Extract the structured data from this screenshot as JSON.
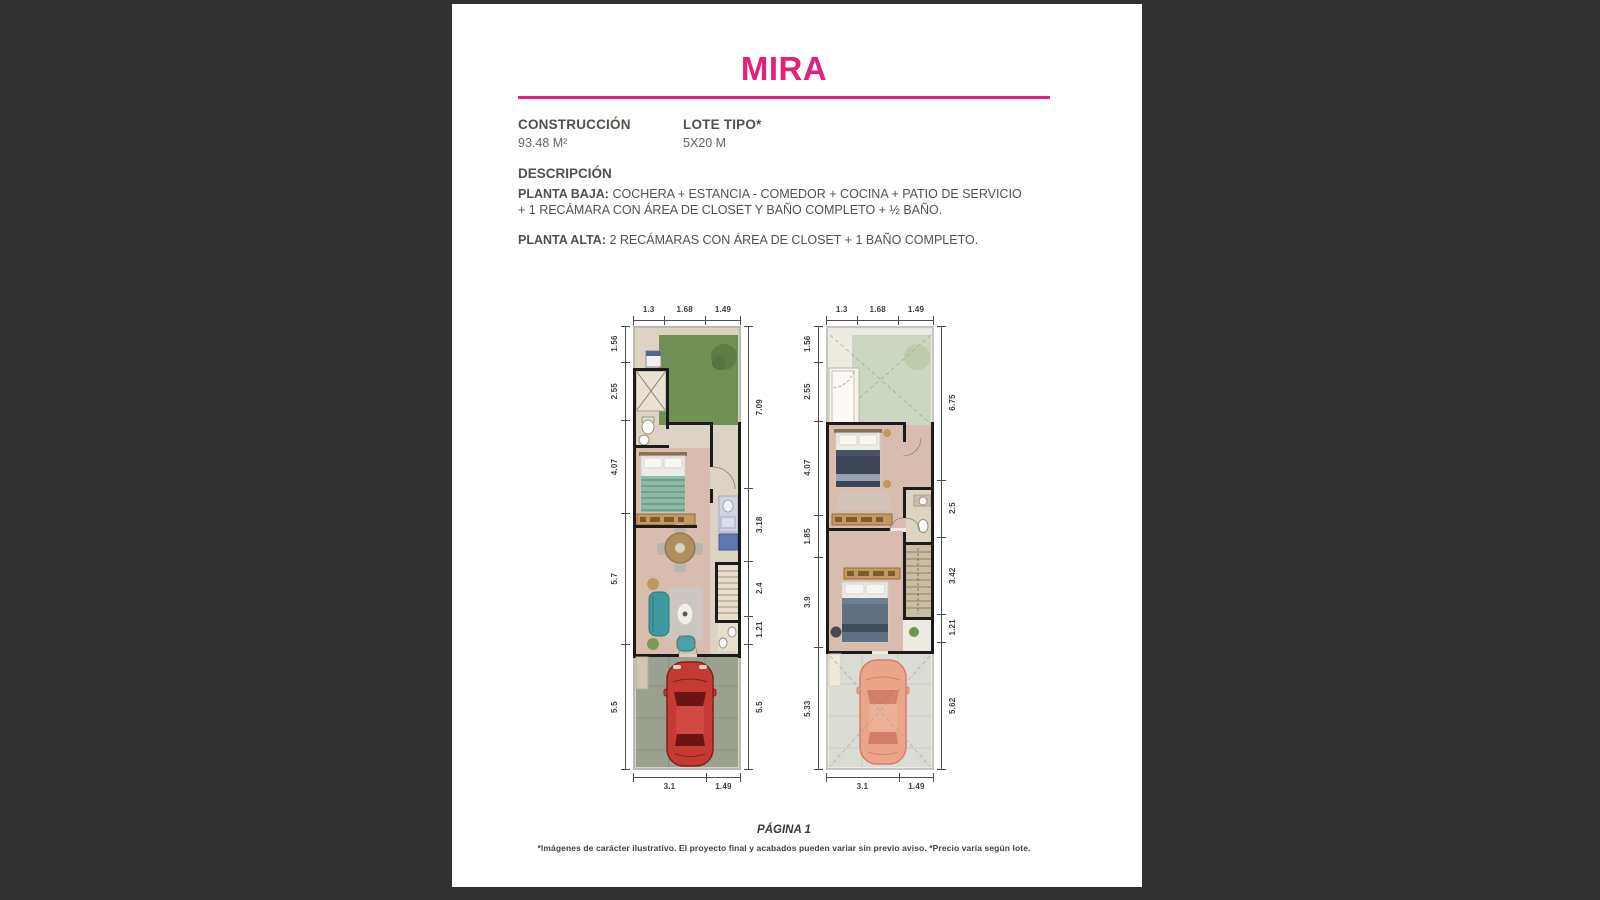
{
  "window": {
    "background": "#313131",
    "page_background": "#ffffff"
  },
  "header": {
    "title": "MIRA",
    "accent_color": "#E5207C"
  },
  "specs": [
    {
      "label": "CONSTRUCCIÓN",
      "value": "93.48 M²"
    },
    {
      "label": "LOTE TIPO*",
      "value": "5X20 M"
    }
  ],
  "description": {
    "heading": "DESCRIPCIÓN",
    "items": [
      {
        "label": "PLANTA BAJA:",
        "text": "COCHERA + ESTANCIA - COMEDOR + COCINA + PATIO DE SERVICIO + 1 RECÁMARA CON ÁREA DE CLOSET Y BAÑO COMPLETO + ½ BAÑO."
      },
      {
        "label": "PLANTA ALTA:",
        "text": "2 RECÁMARAS CON ÁREA DE CLOSET + 1 BAÑO COMPLETO."
      }
    ]
  },
  "plans": [
    {
      "name": "planta-baja",
      "dims_top": [
        "1.3",
        "1.68",
        "1.49"
      ],
      "dims_left": [
        "1.56",
        "2.55",
        "4.07",
        "5.7",
        "5.5"
      ],
      "dims_right": [
        "7.09",
        "3.18",
        "2.4",
        "1.21",
        "5.5"
      ],
      "dims_bottom": [
        "3.1",
        "1.49"
      ]
    },
    {
      "name": "planta-alta",
      "dims_top": [
        "1.3",
        "1.68",
        "1.49"
      ],
      "dims_left": [
        "1.56",
        "2.55",
        "4.07",
        "1.85",
        "3.9",
        "5.33"
      ],
      "dims_right": [
        "6.75",
        "2.5",
        "3.42",
        "1.21",
        "5.62"
      ],
      "dims_bottom": [
        "3.1",
        "1.49"
      ]
    }
  ],
  "footer": {
    "page_label": "PÁGINA 1",
    "disclaimer": "*Imágenes de carácter ilustrativo. El proyecto final y acabados pueden variar sin previo aviso. *Precio varía según lote."
  }
}
